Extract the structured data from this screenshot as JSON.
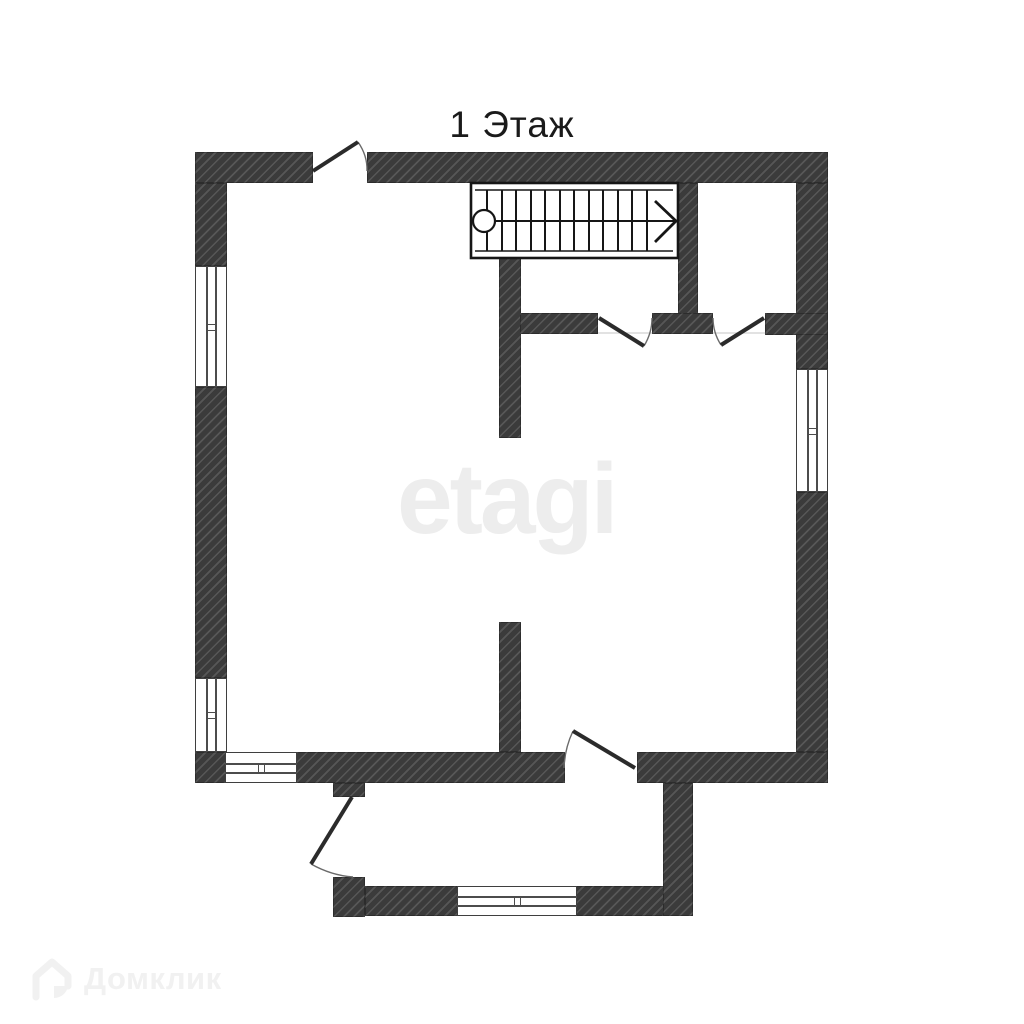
{
  "title": {
    "text": "1 Этаж"
  },
  "watermarks": {
    "center": "etagi",
    "brand": "Домклик"
  },
  "colors": {
    "background": "#ffffff",
    "wall_fill": "#3b3b3b",
    "wall_hatch": "#525252",
    "linework": "#1c1c1c",
    "door_leaf": "#2b2b2b",
    "door_arc": "#6a6a6a",
    "threshold_line": "#d9d9d9",
    "title_text": "#1a1a1a",
    "watermark_center": "#ededed",
    "watermark_brand": "#f1f1f1"
  },
  "floor_plan": {
    "floor_label": "1 Этаж",
    "structure": {
      "outer_walls": [
        "top",
        "left",
        "right",
        "bottom"
      ],
      "annex": "porch attached at bottom between main door and annex right wall",
      "interior_partitions": [
        "stairwell-left-wall",
        "stairwell-right-wall",
        "partition-left-of-door",
        "partition-between-doors",
        "partition-right-of-door",
        "hall-wall-lower"
      ]
    },
    "windows": [
      {
        "id": "window-left-upper",
        "wall": "left"
      },
      {
        "id": "window-left-lower",
        "wall": "left"
      },
      {
        "id": "window-right",
        "wall": "right"
      },
      {
        "id": "window-bottom-left",
        "wall": "bottom"
      },
      {
        "id": "window-annex",
        "wall": "annex-bottom"
      }
    ],
    "doors": [
      {
        "id": "door-top-entry",
        "wall": "top",
        "swing": "outward-up"
      },
      {
        "id": "door-hall-left",
        "wall": "interior-partition",
        "swing": "into-lower-room"
      },
      {
        "id": "door-closet",
        "wall": "interior-partition",
        "swing": "into-lower-room"
      },
      {
        "id": "door-to-annex",
        "wall": "bottom",
        "swing": "into-main-room"
      },
      {
        "id": "door-annex-side",
        "wall": "annex-left",
        "swing": "outward-left"
      }
    ],
    "staircase": {
      "location": "top-right",
      "steps": 12,
      "start_marker": "circle",
      "direction_arrow": "right-chevron"
    }
  }
}
